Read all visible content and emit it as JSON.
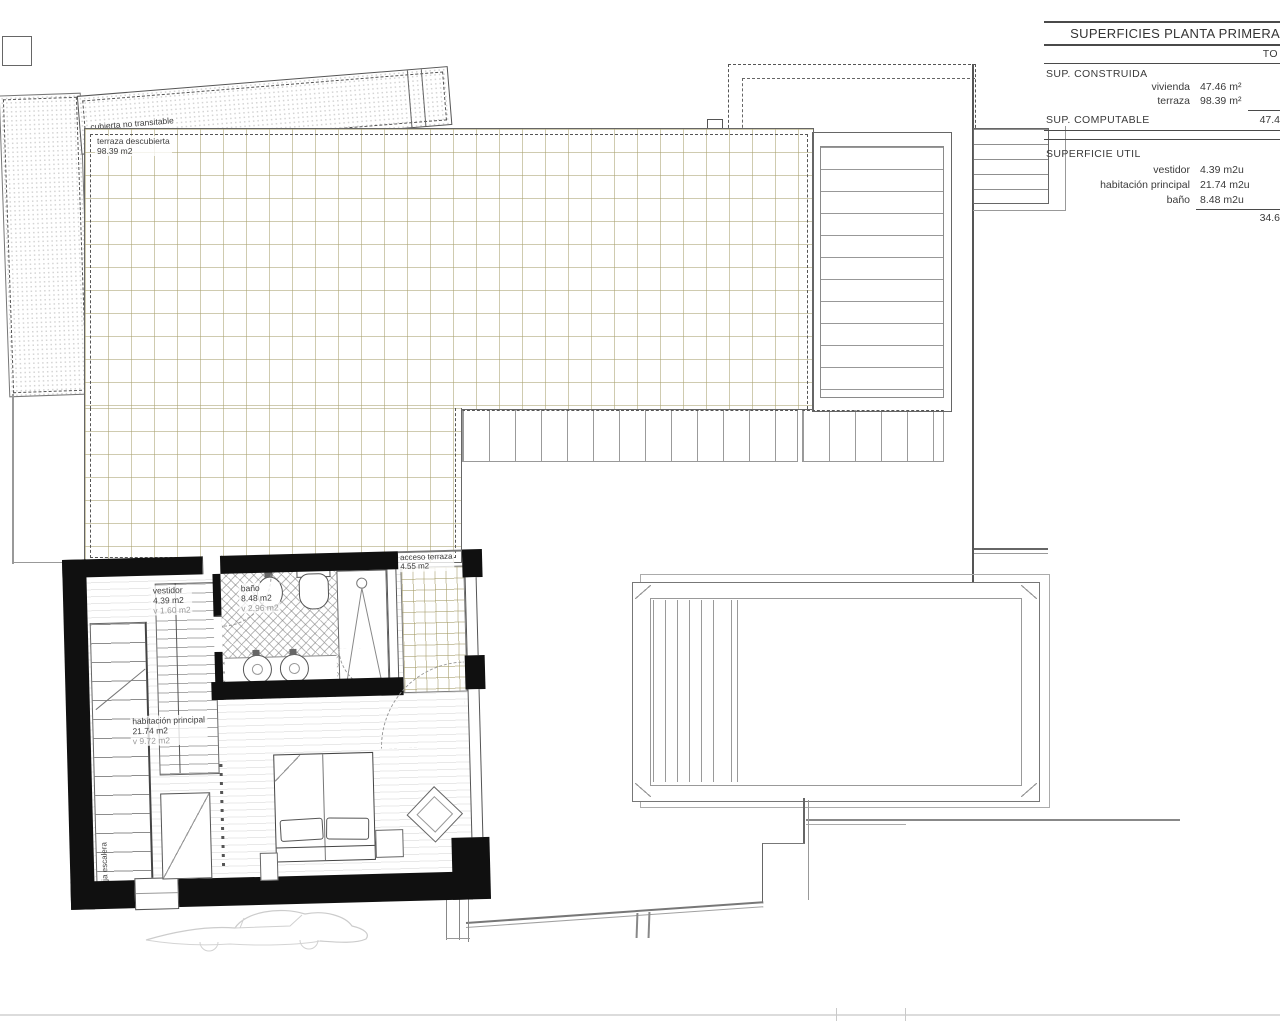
{
  "table": {
    "title": "SUPERFICIES PLANTA PRIMERA",
    "total_column_header": "TO",
    "sup_construida": {
      "name": "SUP. CONSTRUIDA",
      "rows": [
        {
          "label": "vivienda",
          "value": "47.46 m²"
        },
        {
          "label": "terraza",
          "value": "98.39 m²"
        }
      ]
    },
    "sup_computable": {
      "name": "SUP. COMPUTABLE",
      "total": "47.4"
    },
    "superficie_util": {
      "name": "SUPERFICIE UTIL",
      "rows": [
        {
          "label": "vestidor",
          "value": "4.39 m2u"
        },
        {
          "label": "habitación principal",
          "value": "21.74 m2u"
        },
        {
          "label": "baño",
          "value": "8.48 m2u"
        }
      ],
      "total": "34.6"
    }
  },
  "plan": {
    "roof": {
      "name": "cubierta no transitable",
      "area": "98.39 m2"
    },
    "terrace": {
      "name": "terraza descubierta",
      "area": "98.39 m2"
    },
    "terrace_access": {
      "name": "acceso terraza",
      "area": "4.55 m2"
    },
    "dressing": {
      "name": "vestidor",
      "area": "4.39 m2",
      "window": "v 1.60 m2"
    },
    "bath": {
      "name": "baño",
      "area": "8.48 m2",
      "window": "v 2.96 m2"
    },
    "bedroom": {
      "name": "habitación principal",
      "area": "21.74 m2",
      "window": "v 9.72 m2"
    },
    "stairwell": {
      "name": "Caja escalera"
    }
  },
  "colors": {
    "tile_grid": "#c9c3a0",
    "wall": "#111111",
    "line": "#555555"
  }
}
